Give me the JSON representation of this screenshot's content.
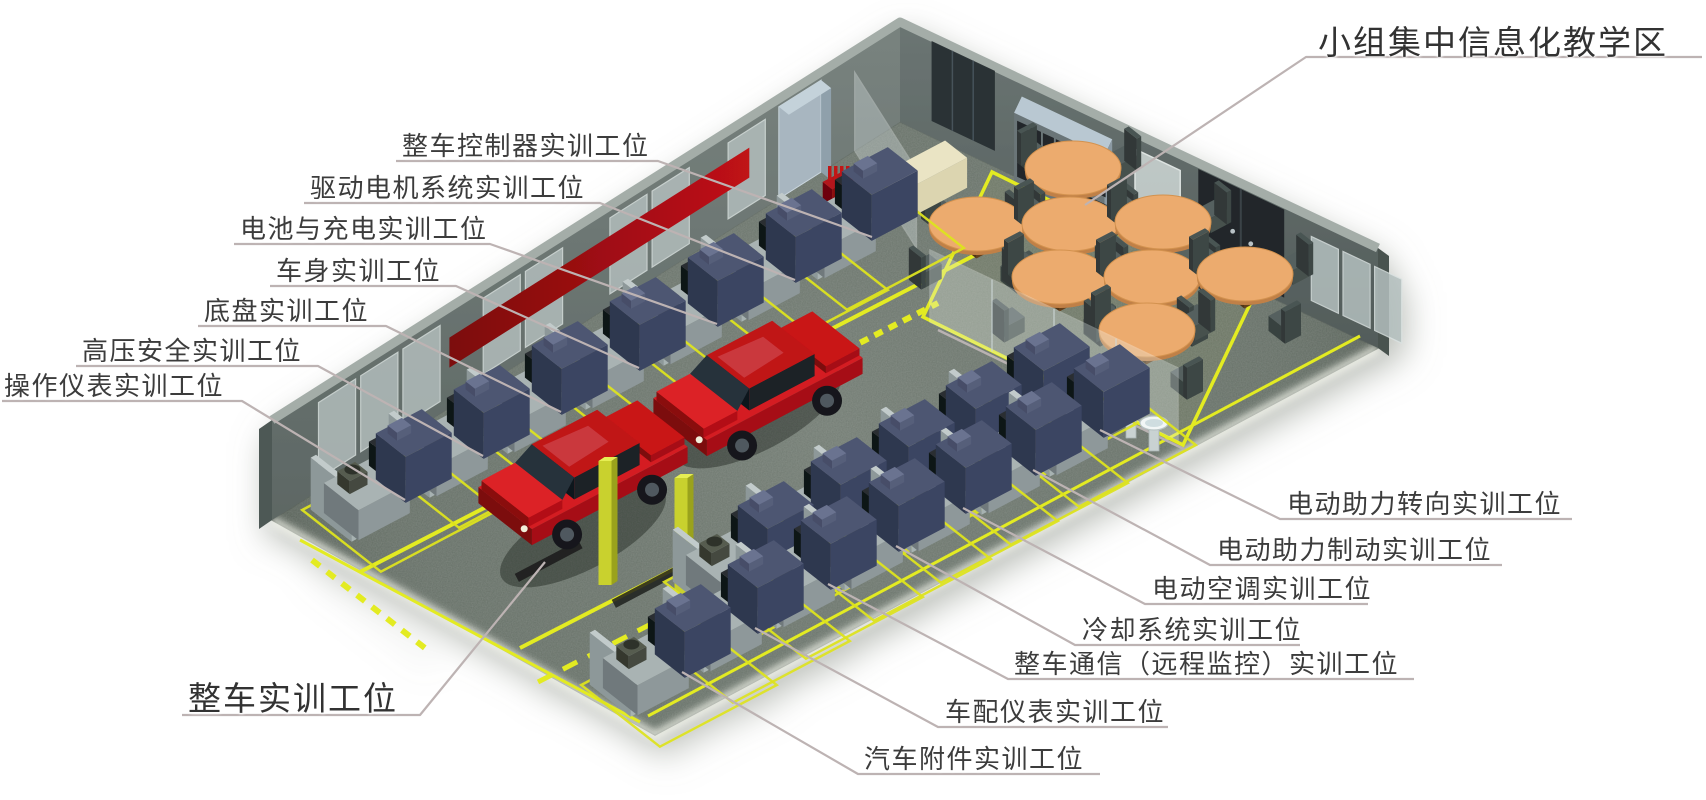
{
  "diagram": {
    "type": "isometric-facility-layout",
    "subject": "新能源汽车实训室布局图",
    "labels": [
      {
        "id": "vehicle-controller-station",
        "text": "整车控制器实训工位",
        "emphasis": false,
        "side": "left"
      },
      {
        "id": "drive-motor-station",
        "text": "驱动电机系统实训工位",
        "emphasis": false,
        "side": "left"
      },
      {
        "id": "battery-charging-station",
        "text": "电池与充电实训工位",
        "emphasis": false,
        "side": "left"
      },
      {
        "id": "body-station",
        "text": "车身实训工位",
        "emphasis": false,
        "side": "left"
      },
      {
        "id": "chassis-station",
        "text": "底盘实训工位",
        "emphasis": false,
        "side": "left"
      },
      {
        "id": "hv-safety-station",
        "text": "高压安全实训工位",
        "emphasis": false,
        "side": "left"
      },
      {
        "id": "instrument-operation-station",
        "text": "操作仪表实训工位",
        "emphasis": false,
        "side": "left"
      },
      {
        "id": "whole-vehicle-station",
        "text": "整车实训工位",
        "emphasis": true,
        "side": "bottom-left"
      },
      {
        "id": "group-teaching-area",
        "text": "小组集中信息化教学区",
        "emphasis": true,
        "side": "top-right"
      },
      {
        "id": "eps-steering-station",
        "text": "电动助力转向实训工位",
        "emphasis": false,
        "side": "right"
      },
      {
        "id": "eps-braking-station",
        "text": "电动助力制动实训工位",
        "emphasis": false,
        "side": "right"
      },
      {
        "id": "electric-ac-station",
        "text": "电动空调实训工位",
        "emphasis": false,
        "side": "right"
      },
      {
        "id": "cooling-system-station",
        "text": "冷却系统实训工位",
        "emphasis": false,
        "side": "right"
      },
      {
        "id": "vehicle-communication-station",
        "text": "整车通信（远程监控）实训工位",
        "emphasis": false,
        "side": "right"
      },
      {
        "id": "dashboard-instrument-station",
        "text": "车配仪表实训工位",
        "emphasis": false,
        "side": "right"
      },
      {
        "id": "auto-accessories-station",
        "text": "汽车附件实训工位",
        "emphasis": false,
        "side": "right"
      }
    ],
    "objects": [
      "isometric-room",
      "workshop-floor",
      "red-sedan-car",
      "red-car-on-lift",
      "two-post-lift",
      "training-workbench",
      "equipment-cabinet",
      "bench-monitor",
      "round-discussion-table",
      "chair",
      "wash-basin",
      "storage-shelf",
      "glass-partition",
      "wall-window",
      "dark-door",
      "whiteboard",
      "red-wall-banner",
      "fire-extinguisher-stand",
      "yellow-floor-marking",
      "beige-side-table"
    ],
    "colors": {
      "background": "#ffffff",
      "floor": "#667067",
      "wall": "#6b7574",
      "wall_rim": "#a4ada8",
      "marking_yellow": "#e3eb20",
      "car_red": "#c9141a",
      "lift_yellow": "#c9d12e",
      "table_top_orange": "#ecab6e",
      "cabinet_navy": "#3b4462",
      "banner_red": "#a50d12",
      "label_ink": "#3c3c3c",
      "leader_line": "#bdb3b3"
    }
  }
}
